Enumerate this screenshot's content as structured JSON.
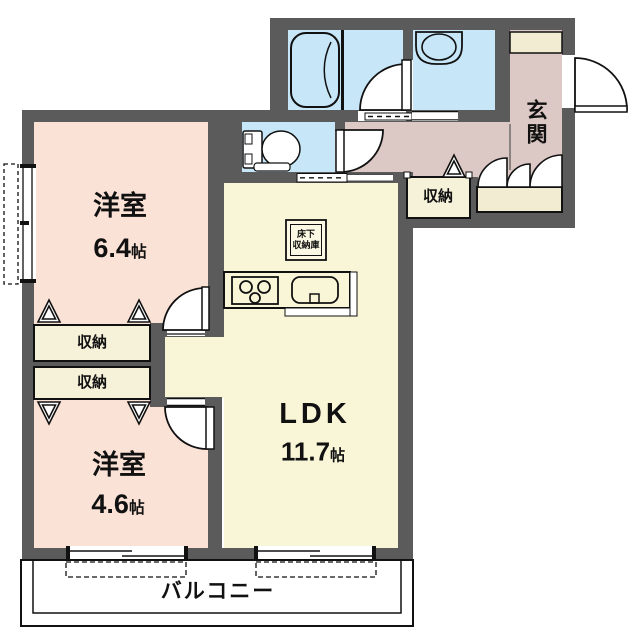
{
  "floorplan": {
    "type": "apartment-floor-plan",
    "rooms": {
      "bedroom1": {
        "name": "洋室",
        "size": "6.4",
        "unit": "帖"
      },
      "bedroom2": {
        "name": "洋室",
        "size": "4.6",
        "unit": "帖"
      },
      "ldk": {
        "name": "LDK",
        "size": "11.7",
        "unit": "帖"
      },
      "entrance": {
        "name": "玄関"
      },
      "balcony": {
        "name": "バルコニー"
      },
      "hall_storage": {
        "name": "収納"
      },
      "closet_upper": {
        "name": "収納"
      },
      "closet_lower": {
        "name": "収納"
      },
      "underfloor_storage": {
        "line1": "床下",
        "line2": "収納庫"
      }
    },
    "colors": {
      "wall": "#5b5b5b",
      "bedroom": "#fbe2d6",
      "ldk": "#f9f6d8",
      "wet_area": "#c7e6f7",
      "hall": "#dcc8c4",
      "storage": "#f6f2da",
      "cabinet": "#f2ecd2",
      "line": "#111111"
    }
  }
}
